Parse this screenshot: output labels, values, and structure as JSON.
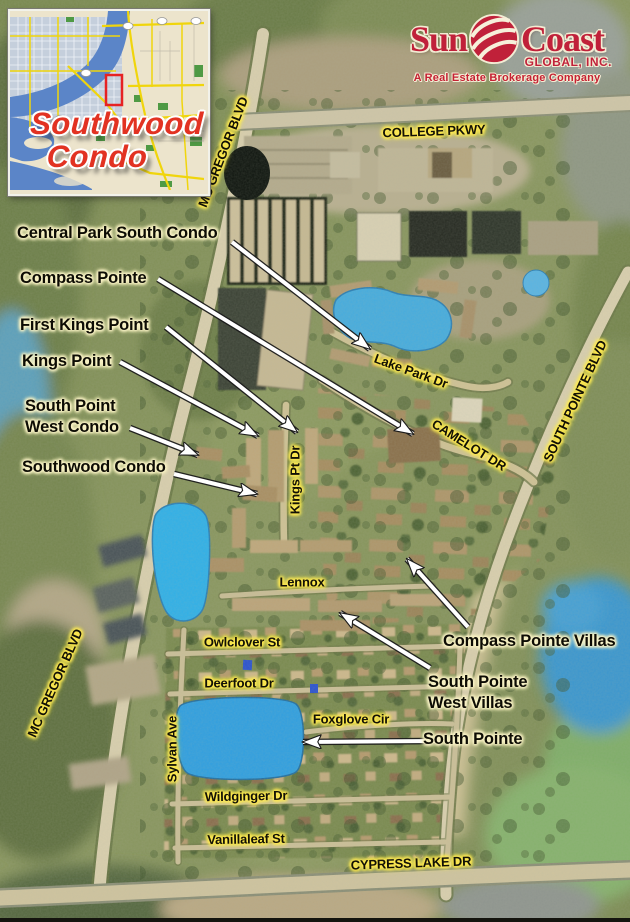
{
  "inset": {
    "title_line1": "Southwood",
    "title_line2": "Condo",
    "title_color": "#e23222"
  },
  "logo": {
    "word1": "Sun",
    "word2": "Coast",
    "subtitle": "GLOBAL, INC.",
    "tagline": "A Real Estate Brokerage Company",
    "brand_color": "#c0213a",
    "globe_icon": "globe-icon"
  },
  "aerial": {
    "colors": {
      "water": "#2fa7e2",
      "arrow_fill": "#ffffff",
      "arrow_outline": "#1c1c1c",
      "label_text": "#0d0c04",
      "community_glow": "#faf4cb",
      "road_glow": "#ffe94f"
    },
    "community_labels": [
      {
        "id": "central-park-south-condo",
        "lines": [
          "Central Park South Condo"
        ],
        "x": 17,
        "y": 223
      },
      {
        "id": "compass-pointe",
        "lines": [
          "Compass Pointe"
        ],
        "x": 20,
        "y": 268
      },
      {
        "id": "first-kings-point",
        "lines": [
          "First Kings Point"
        ],
        "x": 20,
        "y": 315
      },
      {
        "id": "kings-point",
        "lines": [
          "Kings Point"
        ],
        "x": 22,
        "y": 351
      },
      {
        "id": "south-point-west-condo",
        "lines": [
          "South Point",
          "West Condo"
        ],
        "x": 25,
        "y": 396
      },
      {
        "id": "southwood-condo",
        "lines": [
          "Southwood Condo"
        ],
        "x": 22,
        "y": 457
      },
      {
        "id": "compass-pointe-villas",
        "lines": [
          "Compass Pointe Villas"
        ],
        "x": 443,
        "y": 631
      },
      {
        "id": "south-pointe-west-villas",
        "lines": [
          "South Pointe",
          "West Villas"
        ],
        "x": 428,
        "y": 672
      },
      {
        "id": "south-pointe",
        "lines": [
          "South Pointe"
        ],
        "x": 423,
        "y": 729
      }
    ],
    "road_labels": [
      {
        "id": "mc-gregor-blvd-top",
        "text": "MC GREGOR BLVD",
        "cx": 223,
        "cy": 152,
        "rotate": -69,
        "size": 13
      },
      {
        "id": "college-pkwy",
        "text": "COLLEGE PKWY",
        "cx": 434,
        "cy": 131,
        "rotate": -2,
        "size": 13
      },
      {
        "id": "south-pointe-blvd",
        "text": "SOUTH POINTE BLVD",
        "cx": 575,
        "cy": 401,
        "rotate": -65,
        "size": 13
      },
      {
        "id": "lake-park-dr",
        "text": "Lake Park Dr",
        "cx": 411,
        "cy": 371,
        "rotate": 20,
        "size": 13
      },
      {
        "id": "camelot-dr",
        "text": "CAMELOT DR",
        "cx": 469,
        "cy": 445,
        "rotate": 32,
        "size": 13
      },
      {
        "id": "kings-pt-dr",
        "text": "Kings Pt Dr",
        "cx": 295,
        "cy": 480,
        "rotate": -90,
        "size": 13
      },
      {
        "id": "lennox",
        "text": "Lennox",
        "cx": 302,
        "cy": 582,
        "rotate": 0,
        "size": 13
      },
      {
        "id": "owlclover-st",
        "text": "Owlclover St",
        "cx": 242,
        "cy": 642,
        "rotate": 0,
        "size": 13
      },
      {
        "id": "deerfoot-dr",
        "text": "Deerfoot Dr",
        "cx": 239,
        "cy": 683,
        "rotate": 0,
        "size": 13
      },
      {
        "id": "foxglove-cir",
        "text": "Foxglove Cir",
        "cx": 351,
        "cy": 719,
        "rotate": 0,
        "size": 13
      },
      {
        "id": "sylvan-ave",
        "text": "Sylvan Ave",
        "cx": 172,
        "cy": 749,
        "rotate": -90,
        "size": 13
      },
      {
        "id": "wildginger-dr",
        "text": "Wildginger Dr",
        "cx": 246,
        "cy": 796,
        "rotate": -1,
        "size": 13
      },
      {
        "id": "vanillaleaf-st",
        "text": "Vanillaleaf St",
        "cx": 246,
        "cy": 839,
        "rotate": -1,
        "size": 13
      },
      {
        "id": "cypress-lake-dr",
        "text": "CYPRESS LAKE DR",
        "cx": 411,
        "cy": 863,
        "rotate": -2,
        "size": 13
      },
      {
        "id": "mc-gregor-blvd-left",
        "text": "MC GREGOR BLVD",
        "cx": 55,
        "cy": 683,
        "rotate": -66,
        "size": 13
      }
    ],
    "arrows": [
      {
        "id": "central-park-south-condo",
        "x1": 232,
        "y1": 242,
        "x2": 370,
        "y2": 349
      },
      {
        "id": "compass-pointe",
        "x1": 158,
        "y1": 279,
        "x2": 413,
        "y2": 434
      },
      {
        "id": "first-kings-point",
        "x1": 166,
        "y1": 327,
        "x2": 297,
        "y2": 432
      },
      {
        "id": "kings-point",
        "x1": 120,
        "y1": 362,
        "x2": 258,
        "y2": 436
      },
      {
        "id": "south-point-west-condo",
        "x1": 130,
        "y1": 428,
        "x2": 198,
        "y2": 455
      },
      {
        "id": "southwood-condo",
        "x1": 174,
        "y1": 474,
        "x2": 257,
        "y2": 494
      },
      {
        "id": "compass-pointe-villas",
        "x1": 468,
        "y1": 627,
        "x2": 407,
        "y2": 559
      },
      {
        "id": "south-pointe-west-villas",
        "x1": 430,
        "y1": 668,
        "x2": 340,
        "y2": 613
      },
      {
        "id": "south-pointe",
        "x1": 436,
        "y1": 741,
        "x2": 303,
        "y2": 742
      }
    ]
  }
}
